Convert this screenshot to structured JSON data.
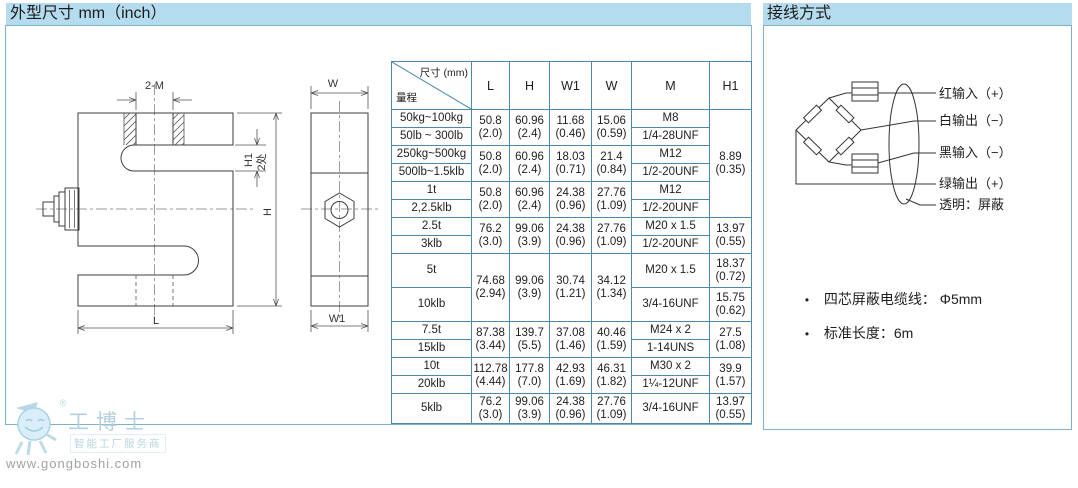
{
  "left_panel": {
    "title": "外型尺寸 mm（inch）",
    "drawing": {
      "dim_2m": "2-M",
      "dim_h1": "H1",
      "dim_2places": "2处",
      "dim_h": "H",
      "dim_l": "L",
      "dim_w": "W",
      "dim_w1": "W1"
    },
    "table": {
      "header": {
        "diag_top": "尺寸 (mm)",
        "diag_bottom": "量程",
        "columns": [
          "L",
          "H",
          "W1",
          "W",
          "M",
          "H1"
        ]
      },
      "rows": [
        {
          "cells": [
            {
              "t": "50kg~100kg"
            },
            {
              "lines": [
                "50.8",
                "(2.0)"
              ],
              "rs": 2
            },
            {
              "lines": [
                "60.96",
                "(2.4)"
              ],
              "rs": 2
            },
            {
              "lines": [
                "11.68",
                "(0.46)"
              ],
              "rs": 2
            },
            {
              "lines": [
                "15.06",
                "(0.59)"
              ],
              "rs": 2
            },
            {
              "t": "M8"
            },
            {
              "lines": [
                "8.89",
                "(0.35)"
              ],
              "rs": 6
            }
          ]
        },
        {
          "cells": [
            {
              "t": "50lb ~ 300lb"
            },
            {
              "t": "1/4-28UNF"
            }
          ]
        },
        {
          "cells": [
            {
              "t": "250kg~500kg"
            },
            {
              "lines": [
                "50.8",
                "(2.0)"
              ],
              "rs": 2
            },
            {
              "lines": [
                "60.96",
                "(2.4)"
              ],
              "rs": 2
            },
            {
              "lines": [
                "18.03",
                "(0.71)"
              ],
              "rs": 2
            },
            {
              "lines": [
                "21.4",
                "(0.84)"
              ],
              "rs": 2
            },
            {
              "t": "M12"
            }
          ]
        },
        {
          "cells": [
            {
              "t": "500lb~1.5klb"
            },
            {
              "t": "1/2-20UNF"
            }
          ]
        },
        {
          "cells": [
            {
              "t": "1t"
            },
            {
              "lines": [
                "50.8",
                "(2.0)"
              ],
              "rs": 2
            },
            {
              "lines": [
                "60.96",
                "(2.4)"
              ],
              "rs": 2
            },
            {
              "lines": [
                "24.38",
                "(0.96)"
              ],
              "rs": 2
            },
            {
              "lines": [
                "27.76",
                "(1.09)"
              ],
              "rs": 2
            },
            {
              "t": "M12"
            }
          ]
        },
        {
          "cells": [
            {
              "t": "2,2.5klb"
            },
            {
              "t": "1/2-20UNF"
            }
          ]
        },
        {
          "cells": [
            {
              "t": "2.5t"
            },
            {
              "lines": [
                "76.2",
                "(3.0)"
              ],
              "rs": 2
            },
            {
              "lines": [
                "99.06",
                "(3.9)"
              ],
              "rs": 2
            },
            {
              "lines": [
                "24.38",
                "(0.96)"
              ],
              "rs": 2
            },
            {
              "lines": [
                "27.76",
                "(1.09)"
              ],
              "rs": 2
            },
            {
              "t": "M20 x 1.5"
            },
            {
              "lines": [
                "13.97",
                "(0.55)"
              ],
              "rs": 2
            }
          ]
        },
        {
          "cells": [
            {
              "t": "3klb"
            },
            {
              "t": "1/2-20UNF"
            }
          ]
        },
        {
          "h": 34,
          "cells": [
            {
              "t": "5t"
            },
            {
              "lines": [
                "74.68",
                "(2.94)"
              ],
              "rs": 2
            },
            {
              "lines": [
                "99.06",
                "(3.9)"
              ],
              "rs": 2
            },
            {
              "lines": [
                "30.74",
                "(1.21)"
              ],
              "rs": 2
            },
            {
              "lines": [
                "34.12",
                "(1.34)"
              ],
              "rs": 2
            },
            {
              "t": "M20 x 1.5"
            },
            {
              "lines": [
                "18.37",
                "(0.72)"
              ]
            }
          ]
        },
        {
          "h": 34,
          "cells": [
            {
              "t": "10klb"
            },
            {
              "t": "3/4-16UNF"
            },
            {
              "lines": [
                "15.75",
                "(0.62)"
              ]
            }
          ]
        },
        {
          "cells": [
            {
              "t": "7.5t"
            },
            {
              "lines": [
                "87.38",
                "(3.44)"
              ],
              "rs": 2
            },
            {
              "lines": [
                "139.7",
                "(5.5)"
              ],
              "rs": 2
            },
            {
              "lines": [
                "37.08",
                "(1.46)"
              ],
              "rs": 2
            },
            {
              "lines": [
                "40.46",
                "(1.59)"
              ],
              "rs": 2
            },
            {
              "t": "M24 x 2"
            },
            {
              "lines": [
                "27.5",
                "(1.08)"
              ],
              "rs": 2
            }
          ]
        },
        {
          "cells": [
            {
              "t": "15klb"
            },
            {
              "t": "1-14UNS"
            }
          ]
        },
        {
          "cells": [
            {
              "t": "10t"
            },
            {
              "lines": [
                "112.78",
                "(4.44)"
              ],
              "rs": 2
            },
            {
              "lines": [
                "177.8",
                "(7.0)"
              ],
              "rs": 2
            },
            {
              "lines": [
                "42.93",
                "(1.69)"
              ],
              "rs": 2
            },
            {
              "lines": [
                "46.31",
                "(1.82)"
              ],
              "rs": 2
            },
            {
              "t": "M30 x 2"
            },
            {
              "lines": [
                "39.9",
                "(1.57)"
              ],
              "rs": 2
            }
          ]
        },
        {
          "cells": [
            {
              "t": "20klb"
            },
            {
              "t": "1¼-12UNF"
            }
          ]
        },
        {
          "h": 30,
          "cells": [
            {
              "t": "5klb"
            },
            {
              "lines": [
                "76.2",
                "(3.0)"
              ]
            },
            {
              "lines": [
                "99.06",
                "(3.9)"
              ]
            },
            {
              "lines": [
                "24.38",
                "(0.96)"
              ]
            },
            {
              "lines": [
                "27.76",
                "(1.09)"
              ]
            },
            {
              "t": "3/4-16UNF"
            },
            {
              "lines": [
                "13.97",
                "(0.55)"
              ]
            }
          ]
        }
      ]
    }
  },
  "right_panel": {
    "title": "接线方式",
    "wire_labels": [
      "红输入（+）",
      "白输出（−）",
      "黑输入（−）",
      "绿输出（+）",
      "透明：屏蔽"
    ],
    "bullet": "•",
    "notes": [
      "四芯屏蔽电缆线： Φ5mm",
      "标准长度：6m"
    ]
  },
  "watermark": {
    "registered": "®",
    "brand": "工博士",
    "slogan": "智能工厂服务商",
    "url": "www.gongboshi.com"
  },
  "colors": {
    "title_bg": "#b4dcee",
    "panel_border": "#7fb0cc",
    "table_border": "#4d87ad",
    "text": "#1e1e1e",
    "watermark_blue": "#b3d0de",
    "watermark_gray": "#a2a2a2"
  }
}
